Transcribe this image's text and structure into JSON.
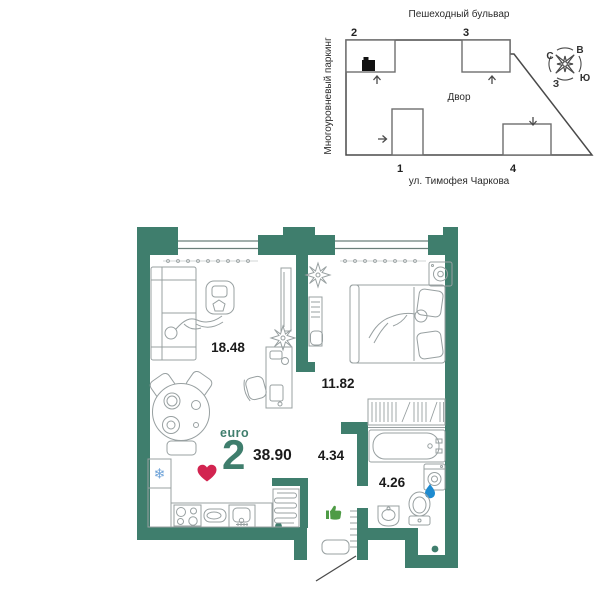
{
  "site_plan": {
    "street_top": "Пешеходный бульвар",
    "street_bottom": "ул. Тимофея Чаркова",
    "parking_label": "Многоуровневый паркинг",
    "courtyard_label": "Двор",
    "buildings": {
      "b1": "1",
      "b2": "2",
      "b3": "3",
      "b4": "4"
    },
    "compass": {
      "north": "С",
      "east": "В",
      "south": "Ю",
      "west": "З"
    }
  },
  "floor_plan": {
    "type_label": "euro",
    "room_count": "2",
    "total_area": "38.90",
    "areas": {
      "living_kitchen": "18.48",
      "bedroom": "11.82",
      "hallway": "4.34",
      "bathroom": "4.26"
    },
    "fridge_snowflake": "❄"
  },
  "colors": {
    "wall_teal": "#3F7E6D",
    "accent_text_teal": "#3F7E6D",
    "heart_red": "#D22450",
    "water_drop_blue": "#1E8BD0",
    "thumb_green": "#4E9B45",
    "snowflake_blue": "#6FA3D8"
  }
}
